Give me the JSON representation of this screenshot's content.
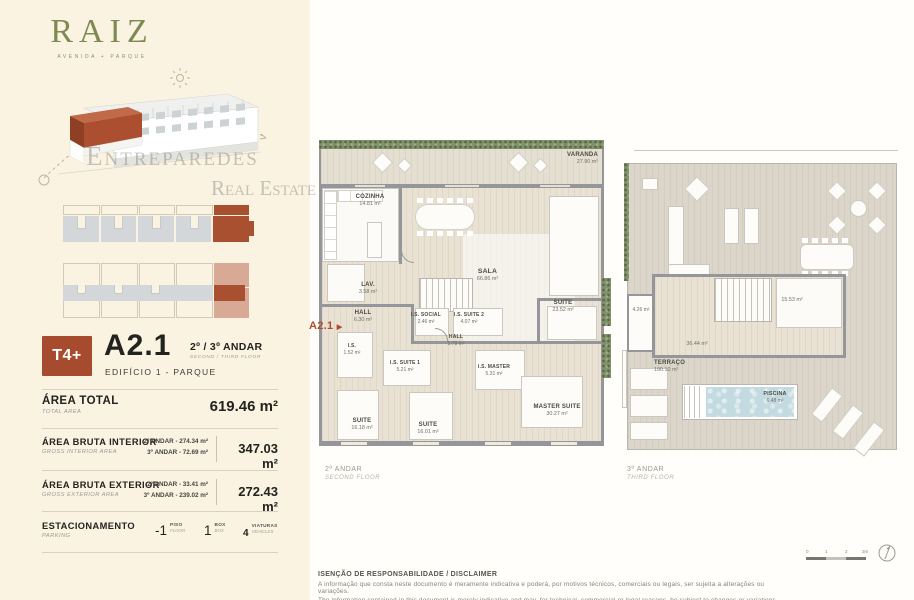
{
  "brand": {
    "logo": "RAIZ",
    "tagline": "AVENIDA + PARQUE",
    "watermark_top": "Entreparedes",
    "watermark_bottom": "Real Estate"
  },
  "unit": {
    "typology": "T4+",
    "code": "A2.1",
    "floors_pt": "2º / 3º ANDAR",
    "floors_en": "SECOND / THIRD FLOOR",
    "building": "EDIFÍCIO 1 - PARQUE"
  },
  "area_total": {
    "label_pt": "ÁREA TOTAL",
    "label_en": "TOTAL AREA",
    "value": "619.46 m²"
  },
  "area_interior": {
    "label_pt": "ÁREA BRUTA INTERIOR",
    "label_en": "GROSS INTERIOR AREA",
    "row1": "2º ANDAR - 274.34 m²",
    "row2": "3º ANDAR - 72.69 m²",
    "total": "347.03 m²"
  },
  "area_exterior": {
    "label_pt": "ÁREA BRUTA EXTERIOR",
    "label_en": "GROSS EXTERIOR AREA",
    "row1": "2º ANDAR - 33.41 m²",
    "row2": "3º ANDAR - 239.02 m²",
    "total": "272.43 m²"
  },
  "parking": {
    "label_pt": "ESTACIONAMENTO",
    "label_en": "PARKING",
    "items": [
      {
        "value": "-1",
        "label_pt": "PISO",
        "label_en": "FLOOR"
      },
      {
        "value": "1",
        "label_pt": "BOX",
        "label_en": "BOX"
      },
      {
        "value": "4",
        "label_pt": "VIATURAS",
        "label_en": "VEHICLES"
      }
    ]
  },
  "marker": {
    "label": "A2.1",
    "arrow": "▶"
  },
  "plan_second": {
    "caption_pt": "2º ANDAR",
    "caption_en": "SECOND FLOOR",
    "rooms": [
      {
        "name": "VARANDA",
        "area": "27.90 m²"
      },
      {
        "name": "COZINHA",
        "area": "14.81 m²"
      },
      {
        "name": "SALA",
        "area": "66.86 m²"
      },
      {
        "name": "LAV.",
        "area": "3.58 m²"
      },
      {
        "name": "HALL",
        "area": "6.30 m²"
      },
      {
        "name": "I.S. SOCIAL",
        "area": "2.46 m²"
      },
      {
        "name": "I.S. SUITE 2",
        "area": "4.07 m²"
      },
      {
        "name": "HALL",
        "area": "5.78 m²"
      },
      {
        "name": "SUITE",
        "area": "23.52 m²"
      },
      {
        "name": "I.S.",
        "area": "1.52 m²"
      },
      {
        "name": "I.S. SUITE 1",
        "area": "5.21 m²"
      },
      {
        "name": "I.S. MASTER",
        "area": "5.31 m²"
      },
      {
        "name": "SUITE",
        "area": "16.18 m²"
      },
      {
        "name": "SUITE",
        "area": "16.01 m²"
      },
      {
        "name": "MASTER SUITE",
        "area": "30.27 m²"
      }
    ]
  },
  "plan_third": {
    "caption_pt": "3º ANDAR",
    "caption_en": "THIRD FLOOR",
    "rooms": [
      {
        "name": "",
        "area": "36.44 m²"
      },
      {
        "name": "",
        "area": "15.53 m²"
      },
      {
        "name": "",
        "area": "4.26 m²"
      },
      {
        "name": "TERRAÇO",
        "area": "190.10 m²"
      },
      {
        "name": "PISCINA",
        "area": "6.48 m²"
      }
    ]
  },
  "disclaimer": {
    "title": "ISENÇÃO DE RESPONSABILIDADE / DISCLAIMER",
    "line_pt": "A informação que consta neste documento é meramente indicativa e poderá, por motivos técnicos, comerciais ou legais, ser sujeita a alterações ou variações.",
    "line_en": "The information contained in this document is merely indicative and may, for technical, commercial or legal reasons, be subject to changes or variations."
  },
  "scalebar": {
    "t0": "0",
    "t1": "1",
    "t2": "2",
    "t3": "3m"
  }
}
